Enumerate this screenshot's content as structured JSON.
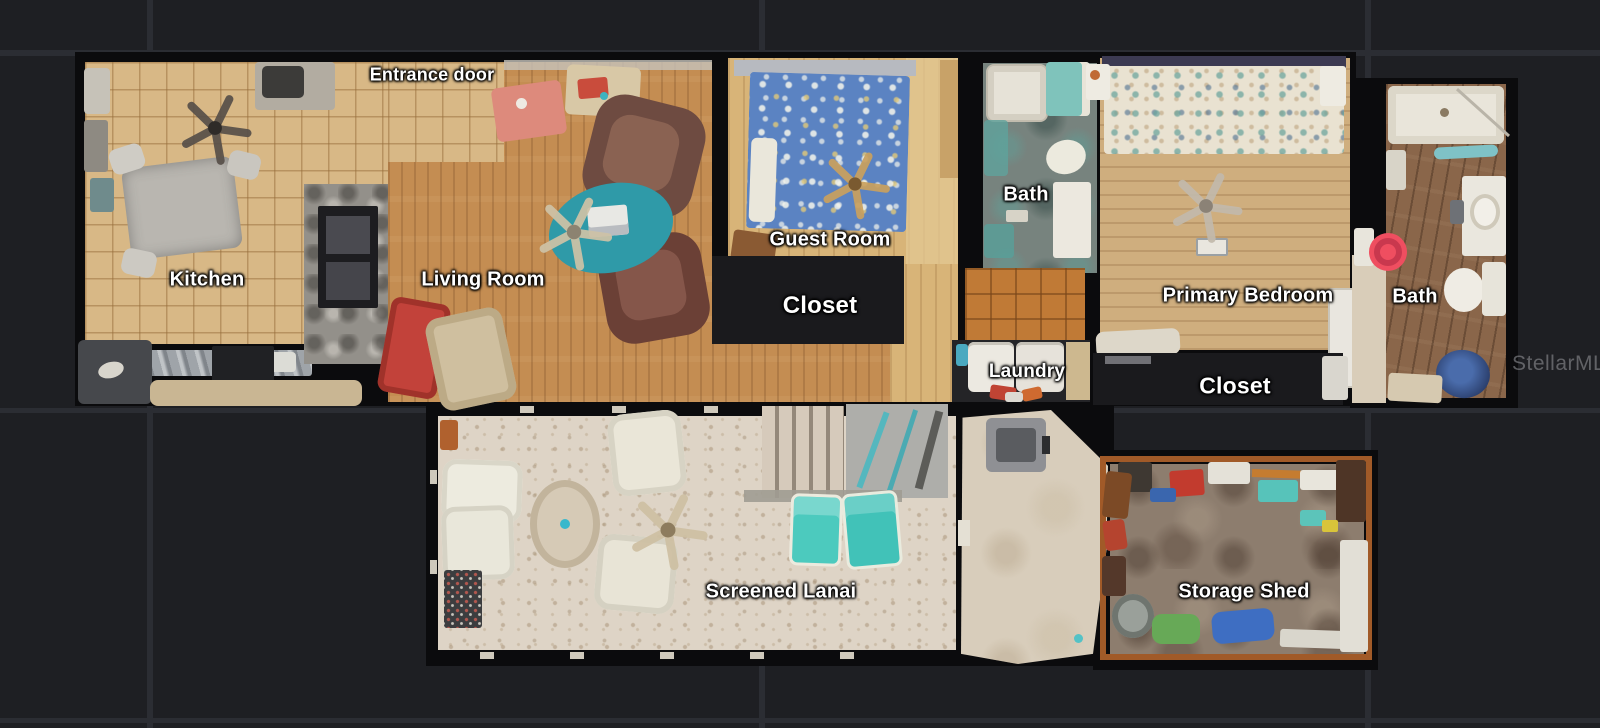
{
  "colors": {
    "background": "#1e1f23",
    "grid_line": "#2b2d33",
    "label_text": "#ffffff",
    "marker": "#ef4e60",
    "marker_ring": "#c9384e",
    "watermark_text": "#8a8b90",
    "closet_fill": "#1a1a1d"
  },
  "watermark": {
    "text": "StellarMLS"
  },
  "rooms": [
    {
      "id": "entrance-door",
      "label": "Entrance door"
    },
    {
      "id": "kitchen",
      "label": "Kitchen"
    },
    {
      "id": "living-room",
      "label": "Living Room"
    },
    {
      "id": "guest-room",
      "label": "Guest Room"
    },
    {
      "id": "closet-guest",
      "label": "Closet"
    },
    {
      "id": "bath-guest",
      "label": "Bath"
    },
    {
      "id": "laundry",
      "label": "Laundry"
    },
    {
      "id": "primary-bedroom",
      "label": "Primary Bedroom"
    },
    {
      "id": "closet-primary",
      "label": "Closet"
    },
    {
      "id": "bath-primary",
      "label": "Bath"
    },
    {
      "id": "screened-lanai",
      "label": "Screened Lanai"
    },
    {
      "id": "storage-shed",
      "label": "Storage Shed"
    }
  ]
}
